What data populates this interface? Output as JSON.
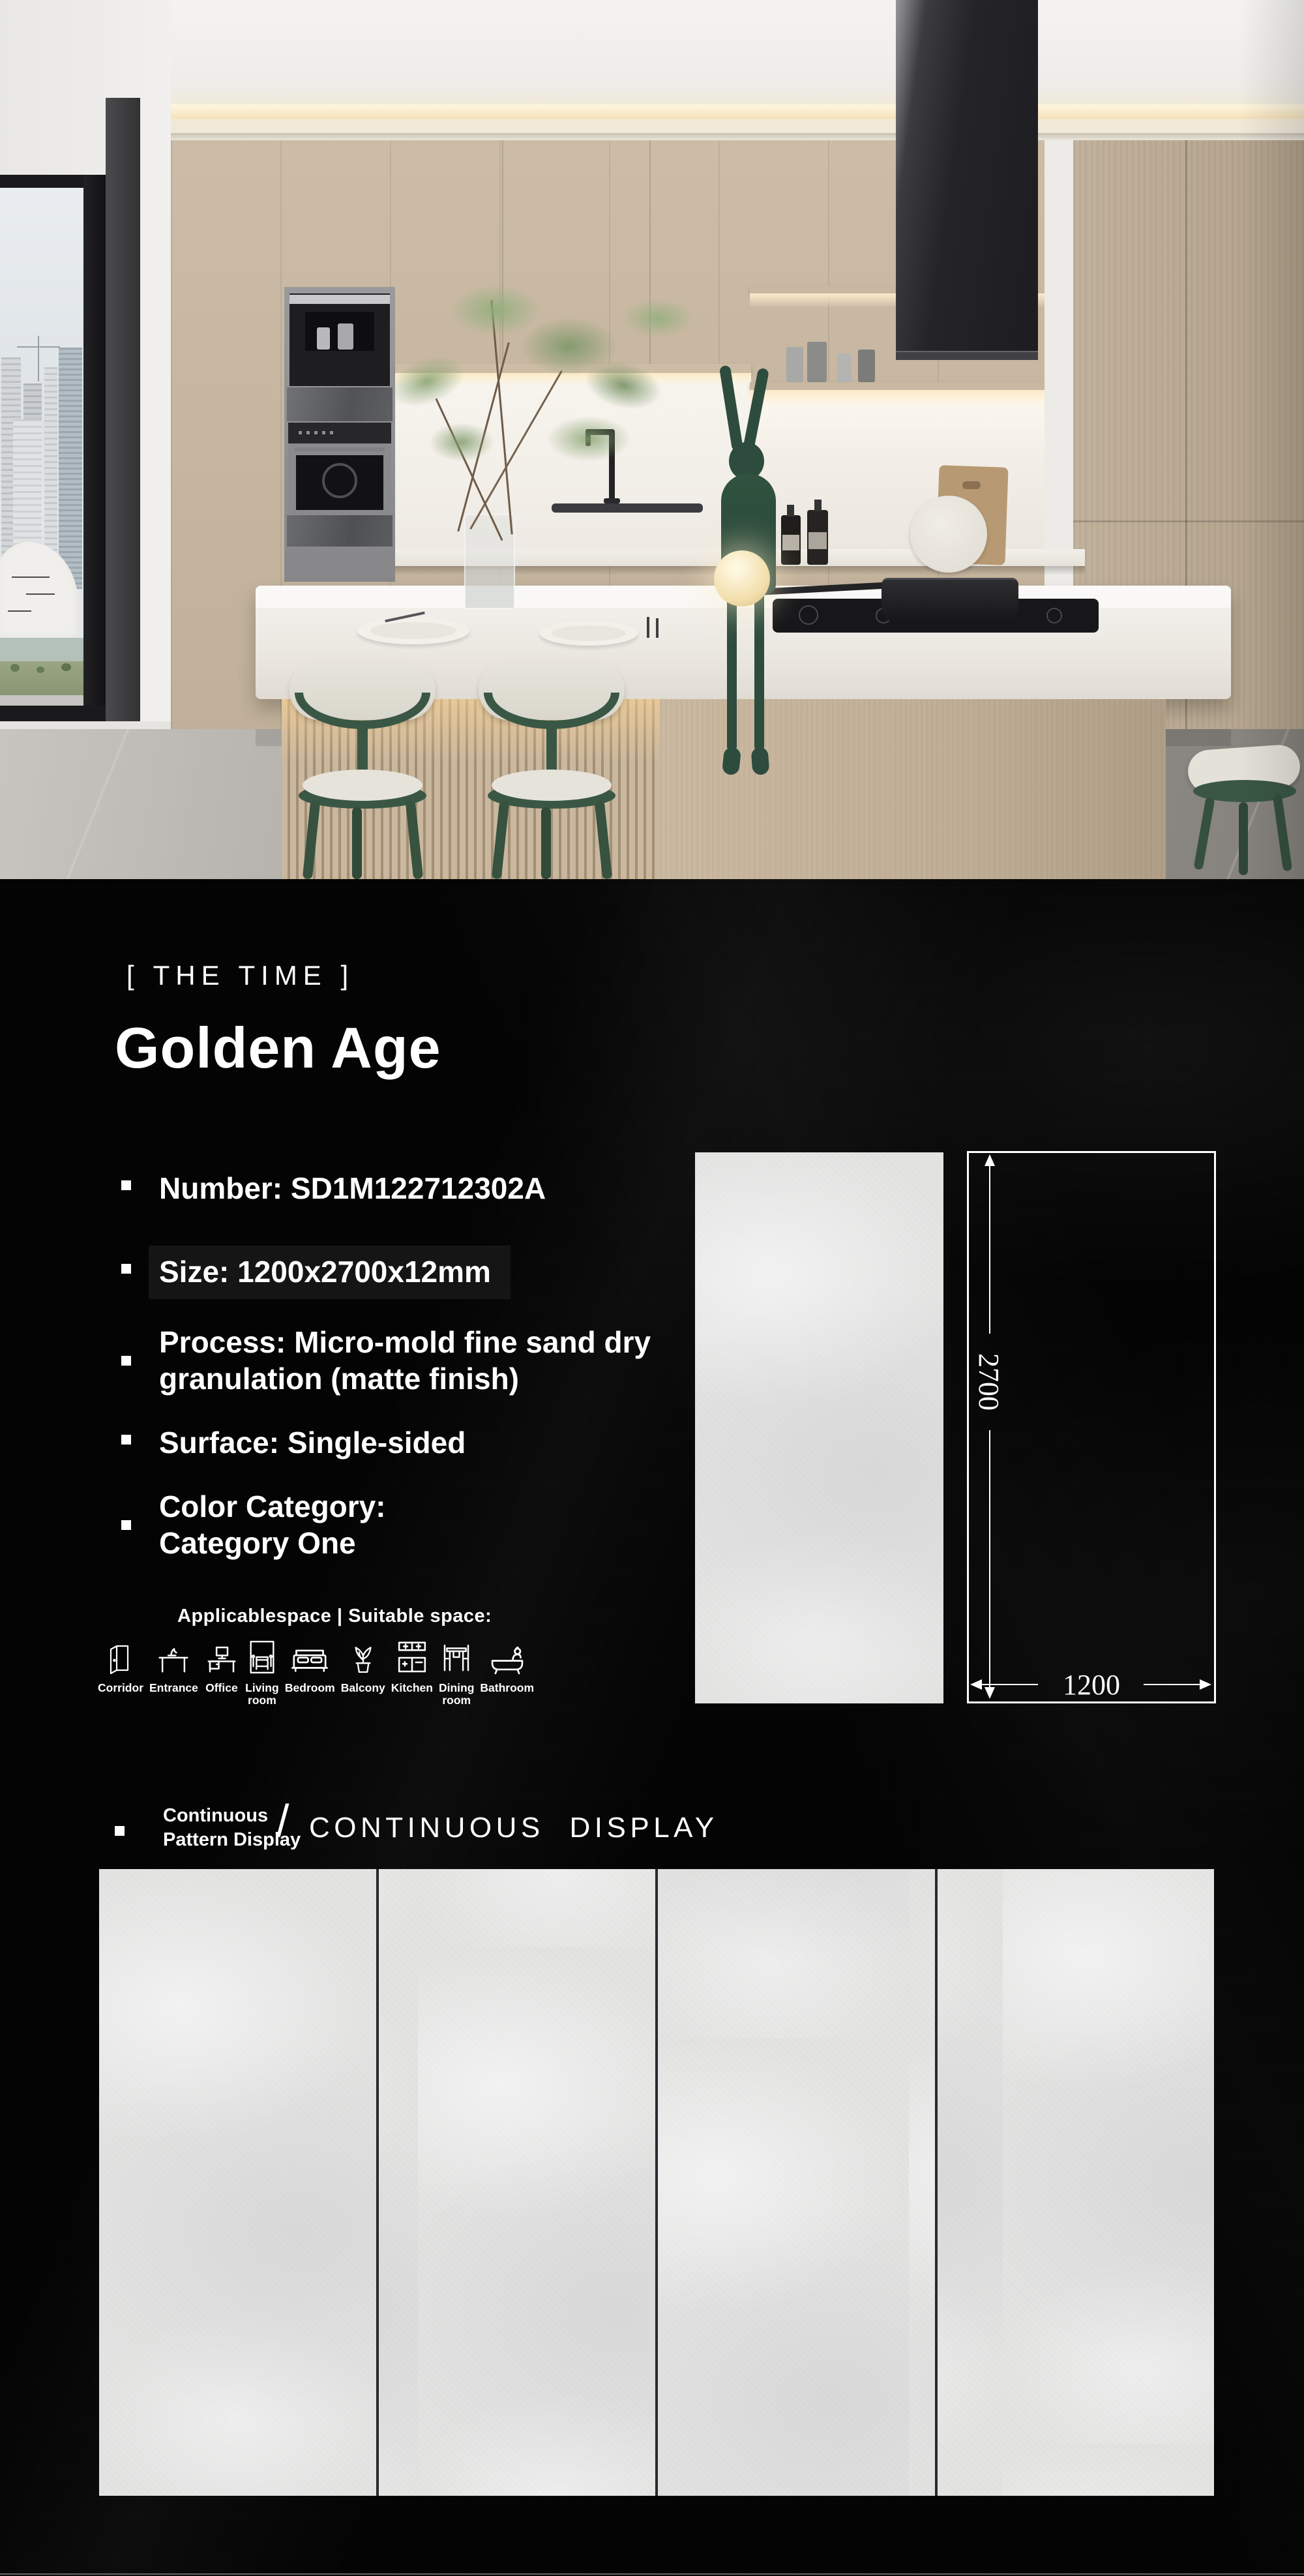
{
  "brand": {
    "logo": "[ THE TIME ]"
  },
  "product": {
    "title": "Golden Age",
    "specs": [
      {
        "text": "Number: SD1M122712302A"
      },
      {
        "text": "Size: 1200x2700x12mm"
      },
      {
        "text": "Process: Micro-mold fine sand dry\ngranulation (matte finish)"
      },
      {
        "text": "Surface: Single-sided"
      },
      {
        "text": "Color Category:\nCategory One"
      }
    ]
  },
  "spaces": {
    "heading": "Applicablespace | Suitable space:",
    "items": [
      {
        "label": "Corridor",
        "icon": "corridor-icon"
      },
      {
        "label": "Entrance",
        "icon": "entrance-icon"
      },
      {
        "label": "Office",
        "icon": "office-icon"
      },
      {
        "label": "Living\nroom",
        "icon": "living-room-icon"
      },
      {
        "label": "Bedroom",
        "icon": "bedroom-icon"
      },
      {
        "label": "Balcony",
        "icon": "balcony-icon"
      },
      {
        "label": "Kitchen",
        "icon": "kitchen-icon"
      },
      {
        "label": "Dining\nroom",
        "icon": "dining-room-icon"
      },
      {
        "label": "Bathroom",
        "icon": "bathroom-icon"
      }
    ]
  },
  "dimensions": {
    "height_mm": "2700",
    "width_mm": "1200"
  },
  "continuous": {
    "label": "Continuous\nPattern Display",
    "separator": "/",
    "title": "CONTINUOUS DISPLAY"
  },
  "colors": {
    "background": "#000000",
    "text": "#ffffff",
    "tile": "#e3e3e2",
    "accent_green": "#3a5745",
    "cabinet_wood": "#c6b6a1"
  }
}
